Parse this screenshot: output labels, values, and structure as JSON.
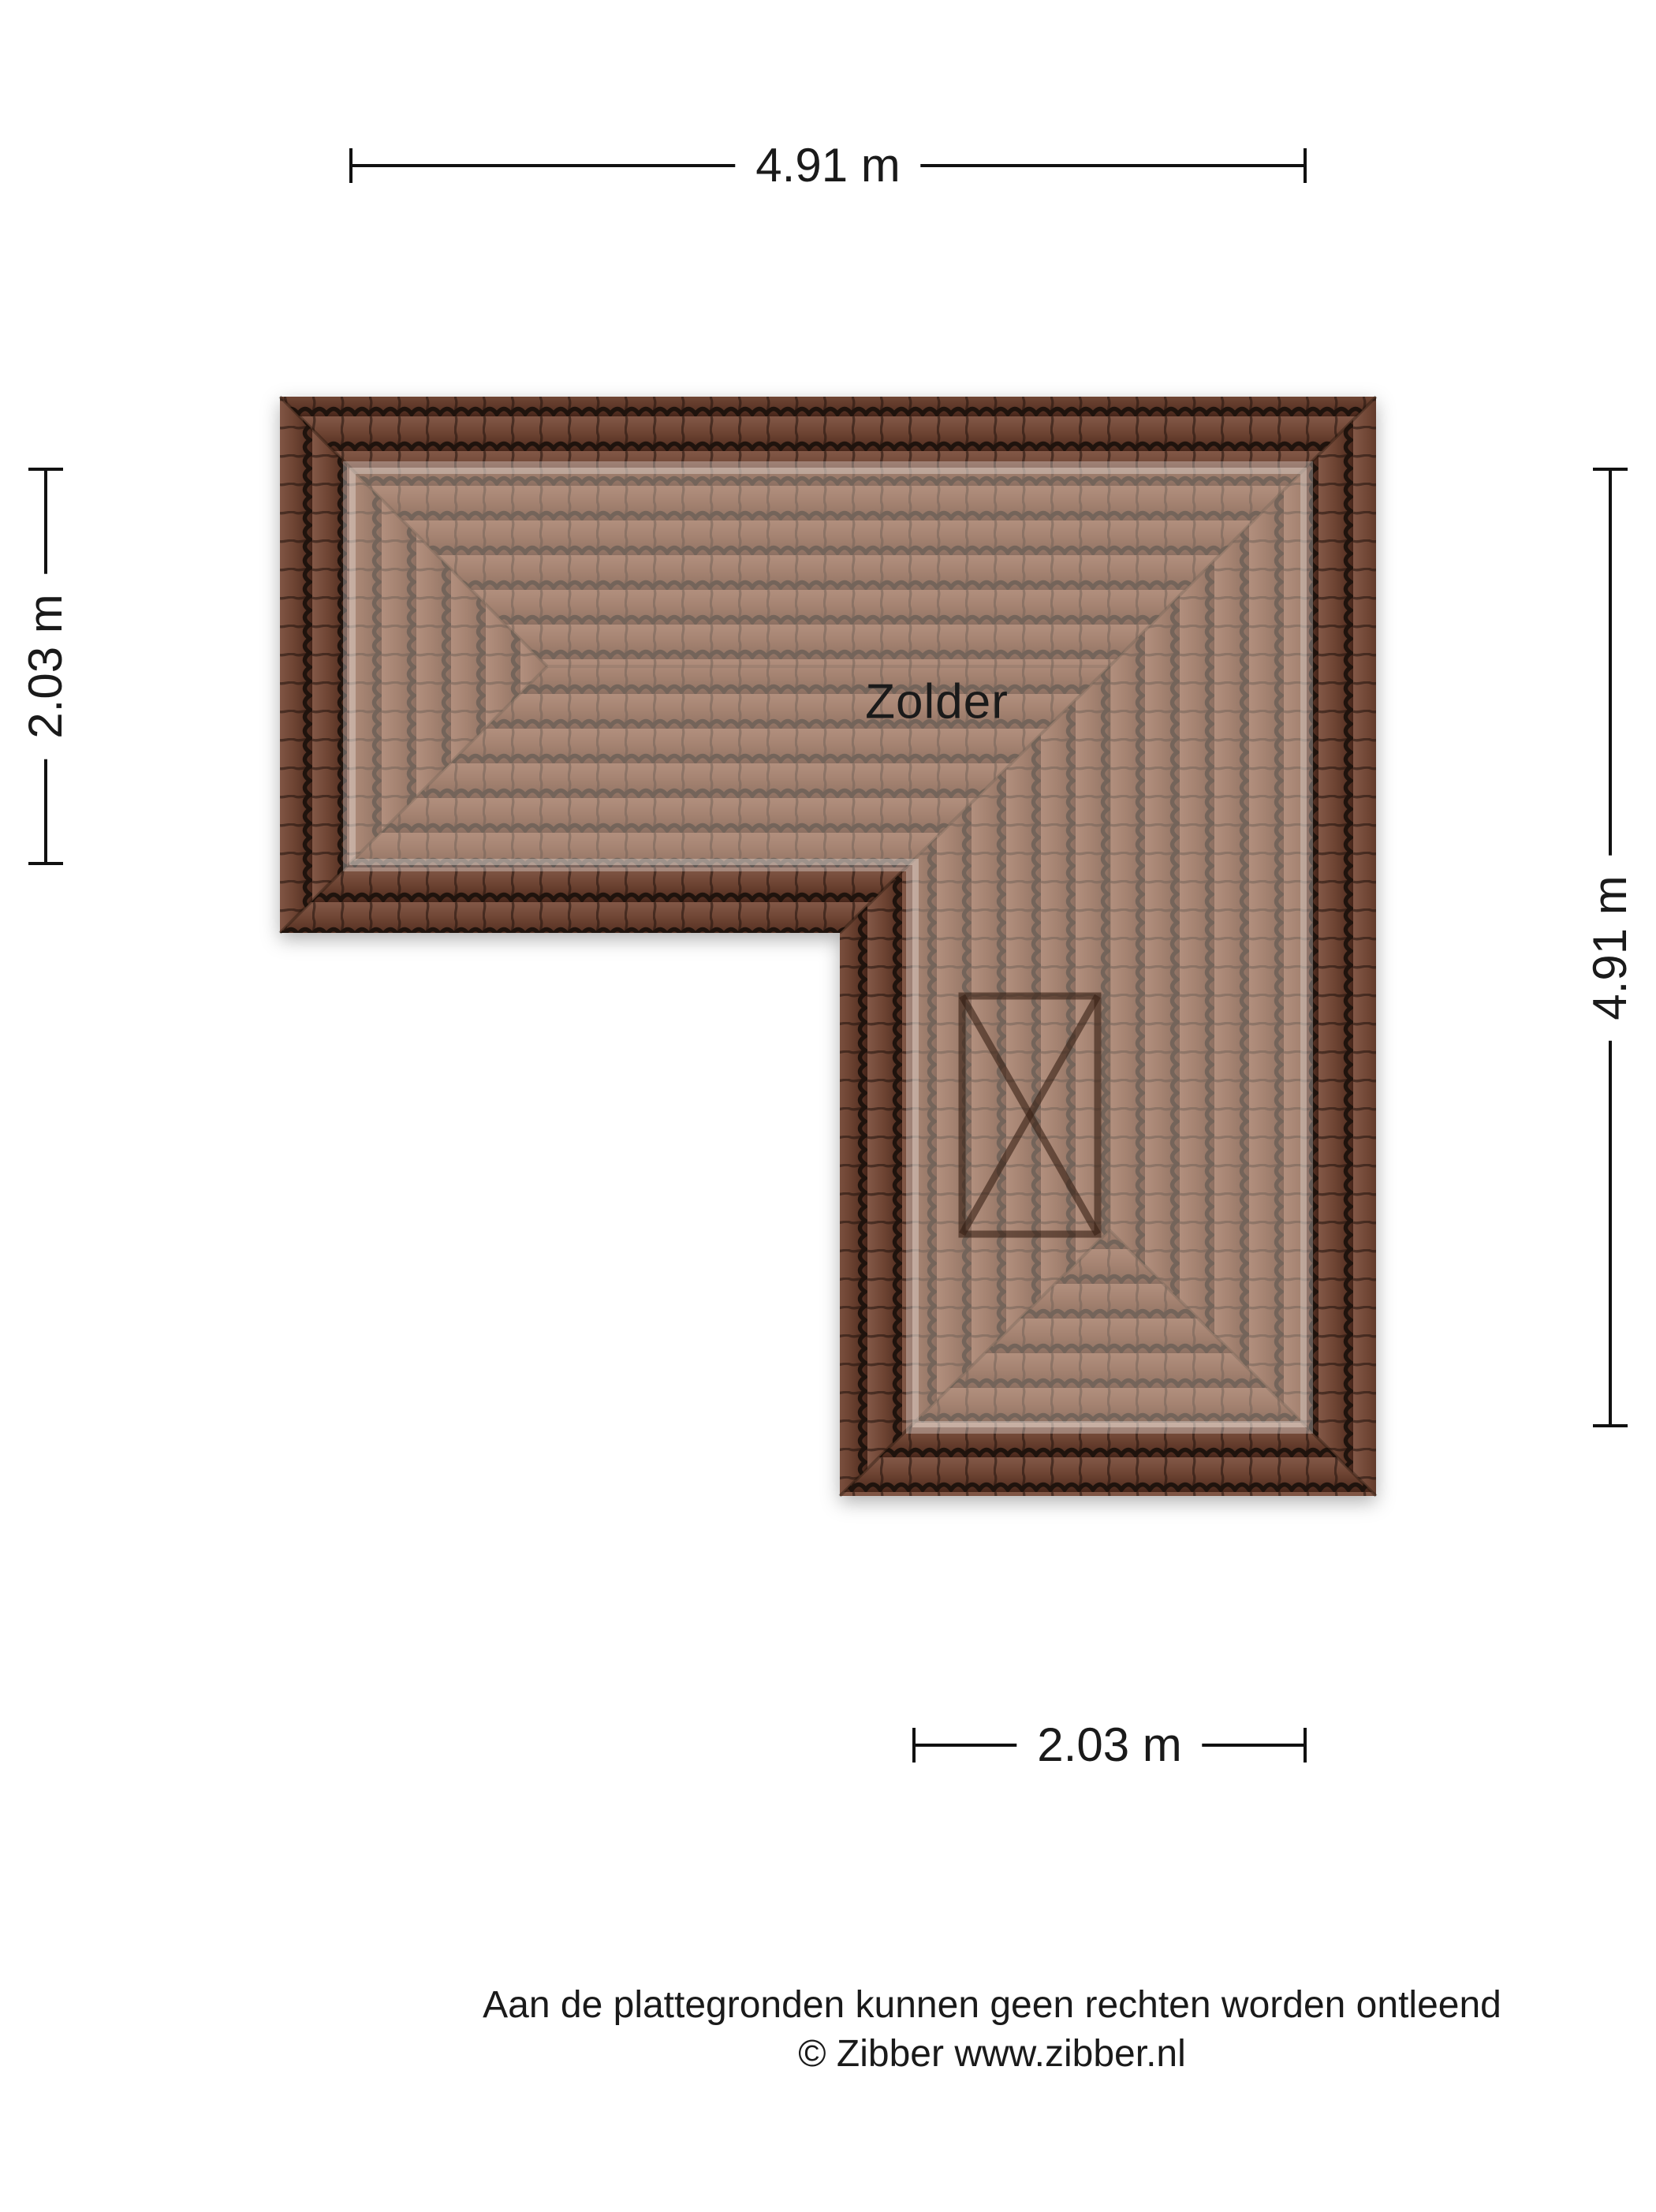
{
  "floorplan": {
    "room_label": "Zolder",
    "dimensions": {
      "top": {
        "label": "4.91 m"
      },
      "left": {
        "label": "2.03 m"
      },
      "right": {
        "label": "4.91 m"
      },
      "bottom": {
        "label": "2.03 m"
      }
    },
    "footer": {
      "disclaimer": "Aan de plattegronden kunnen geen rechten worden ontleend",
      "copyright": "© Zibber www.zibber.nl"
    }
  },
  "colors": {
    "background": "#ffffff",
    "roof_base": "#6e4433",
    "roof_tile_line": "#1f130d",
    "roof_interior": "#a5796a",
    "dimension_line": "#111111",
    "text": "#1a1a1a"
  }
}
